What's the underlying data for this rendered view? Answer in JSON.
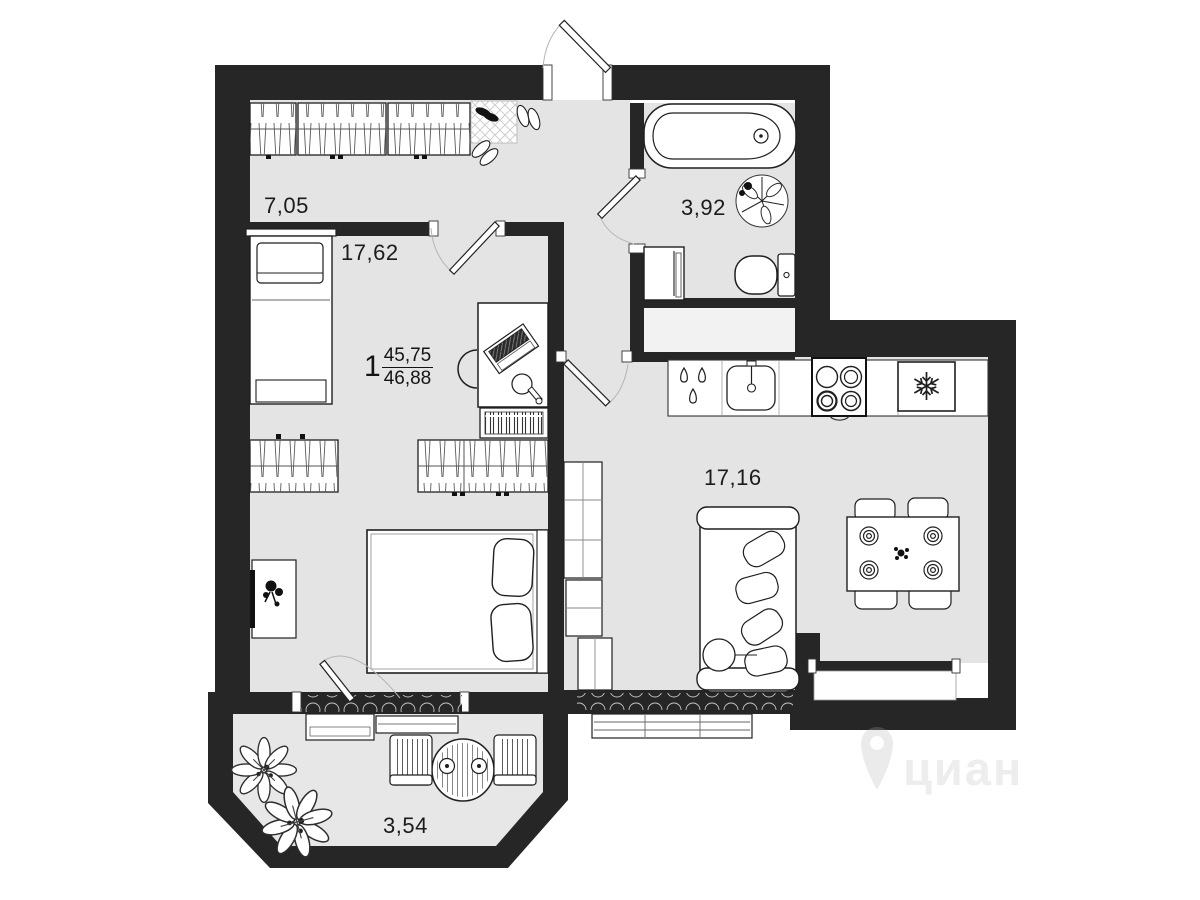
{
  "plan": {
    "apartment_label": {
      "number": "1",
      "area_top": "45,75",
      "area_bottom": "46,88"
    },
    "rooms": [
      {
        "name": "hallway",
        "area": "7,05"
      },
      {
        "name": "room",
        "area": "17,62"
      },
      {
        "name": "bathroom",
        "area": "3,92"
      },
      {
        "name": "kitchen-living",
        "area": "17,16"
      },
      {
        "name": "balcony",
        "area": "3,54"
      }
    ],
    "colors": {
      "wall": "#262626",
      "floor": "#e4e4e4",
      "niche_floor": "#f2f2f2",
      "furniture_outline": "#1f1f1f",
      "furniture_fill": "#ffffff",
      "door_arc": "#b5b5b5",
      "watermark": "#ededed"
    },
    "icons": {
      "fridge": "snowflake-icon",
      "watermark": "map-pin-icon"
    }
  },
  "watermark": {
    "text": "циан"
  }
}
